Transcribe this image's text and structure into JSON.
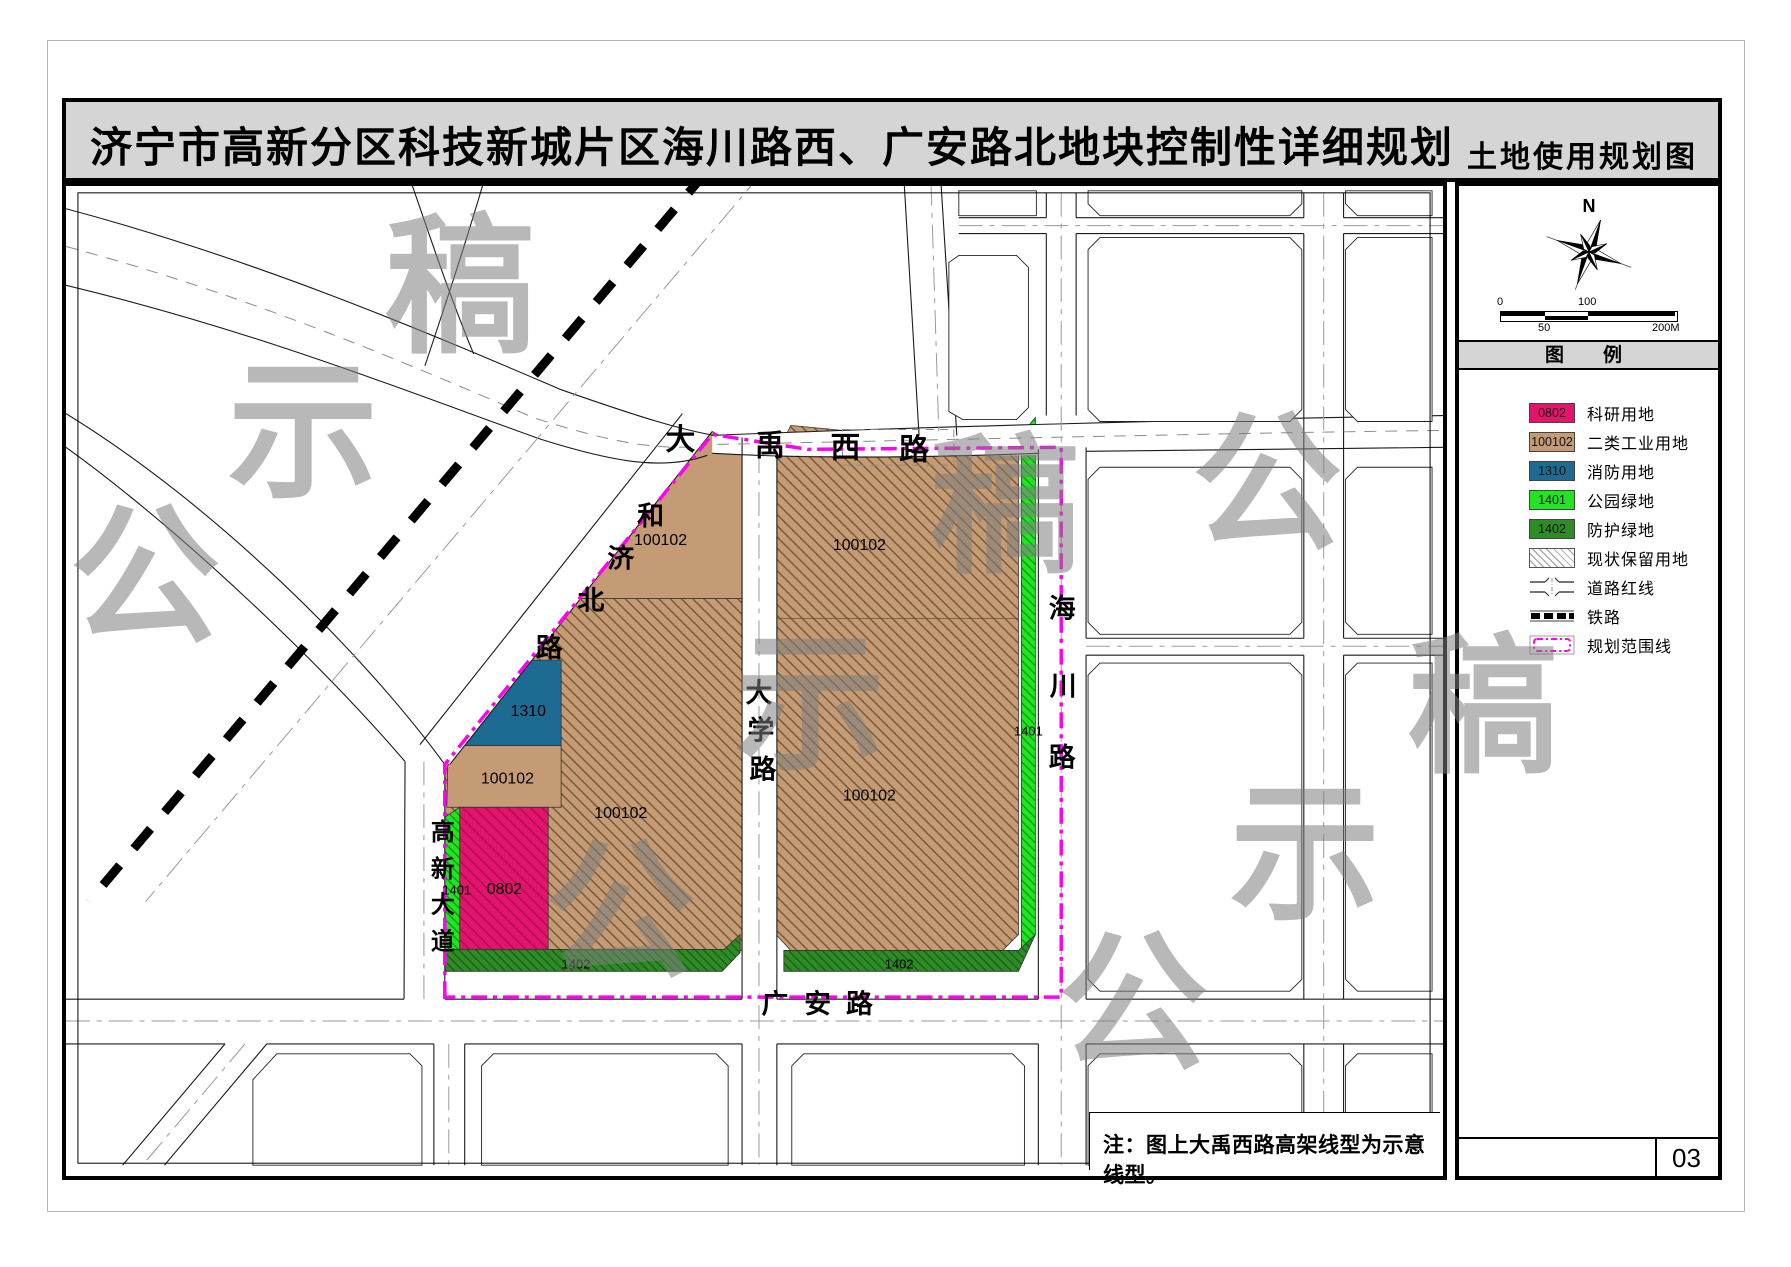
{
  "title": {
    "main": "济宁市高新分区科技新城片区海川路西、广安路北地块控制性详细规划",
    "sheet_label": "土地使用规划图"
  },
  "page_number": "03",
  "note": "注：图上大禹西路高架线型为示意线型。",
  "watermark": {
    "chars": [
      "公",
      "示",
      "稿"
    ]
  },
  "compass": {
    "north": "N"
  },
  "scalebar": {
    "t0": "0",
    "t50": "50",
    "t100": "100",
    "t200": "200M"
  },
  "legend": {
    "header": "图　例",
    "items": [
      {
        "code": "0802",
        "label": "科研用地",
        "type": "color",
        "color": "#E3146B"
      },
      {
        "code": "100102",
        "label": "二类工业用地",
        "type": "color",
        "color": "#C49B74"
      },
      {
        "code": "1310",
        "label": "消防用地",
        "type": "color",
        "color": "#1D6A92"
      },
      {
        "code": "1401",
        "label": "公园绿地",
        "type": "color",
        "color": "#22E522"
      },
      {
        "code": "1402",
        "label": "防护绿地",
        "type": "color",
        "color": "#2E8C26"
      },
      {
        "code": "",
        "label": "现状保留用地",
        "type": "hatch"
      },
      {
        "code": "",
        "label": "道路红线",
        "type": "road"
      },
      {
        "code": "",
        "label": "铁路",
        "type": "rail"
      },
      {
        "code": "",
        "label": "规划范围线",
        "type": "boundary"
      }
    ]
  },
  "map": {
    "roads": {
      "dayuxilu": [
        "大",
        "禹",
        "西",
        "路"
      ],
      "hejibeilu": [
        "和",
        "济",
        "北",
        "路"
      ],
      "daxuelu": [
        "大",
        "学",
        "路"
      ],
      "haichuanlu": [
        "海",
        "川",
        "路"
      ],
      "guanganlu": [
        "广",
        "安",
        "路"
      ],
      "gaoxindadao": [
        "高",
        "新",
        "大",
        "道"
      ]
    },
    "parcel_labels": [
      {
        "code": "100102"
      },
      {
        "code": "100102"
      },
      {
        "code": "100102"
      },
      {
        "code": "1310"
      },
      {
        "code": "0802"
      },
      {
        "code": "1401"
      },
      {
        "code": "1402"
      },
      {
        "code": "100102"
      },
      {
        "code": "100102"
      },
      {
        "code": "1401"
      },
      {
        "code": "1402"
      }
    ]
  },
  "colors": {
    "research": "#E3146B",
    "industrial": "#C49B74",
    "industrial_line": "#7A5A3A",
    "fire": "#1D6A92",
    "park": "#22E522",
    "park_line": "#0B9B10",
    "protect": "#2E8C26",
    "protect_line": "#1C5F16",
    "boundary": "#FF00F0",
    "band": "#D5D5D5"
  }
}
